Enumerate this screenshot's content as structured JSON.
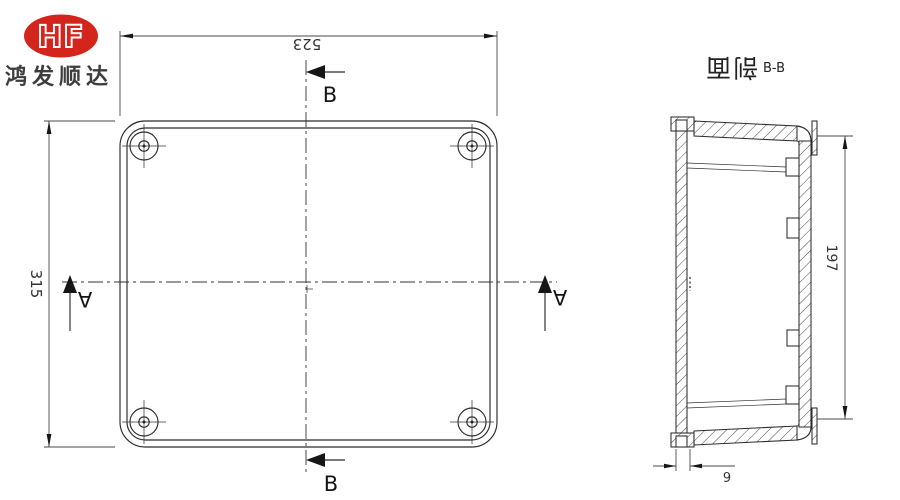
{
  "logo": {
    "monogram": "HF",
    "company": "鸿发顺达",
    "oval_color": "#d3251c",
    "company_text_color": "#3d3d3d"
  },
  "colors": {
    "drawing_line": "#2b2b2b",
    "dimension_line": "#4a4a4a",
    "background": "#ffffff"
  },
  "plan_view": {
    "width_dim": "523",
    "height_dim": "315",
    "section_b_top": "B",
    "section_b_bottom": "B",
    "section_a_left": "A",
    "section_a_right": "A"
  },
  "section_view": {
    "title": "剖面",
    "ref": "B-B",
    "height_dim": "197",
    "lip_dim": "6"
  }
}
